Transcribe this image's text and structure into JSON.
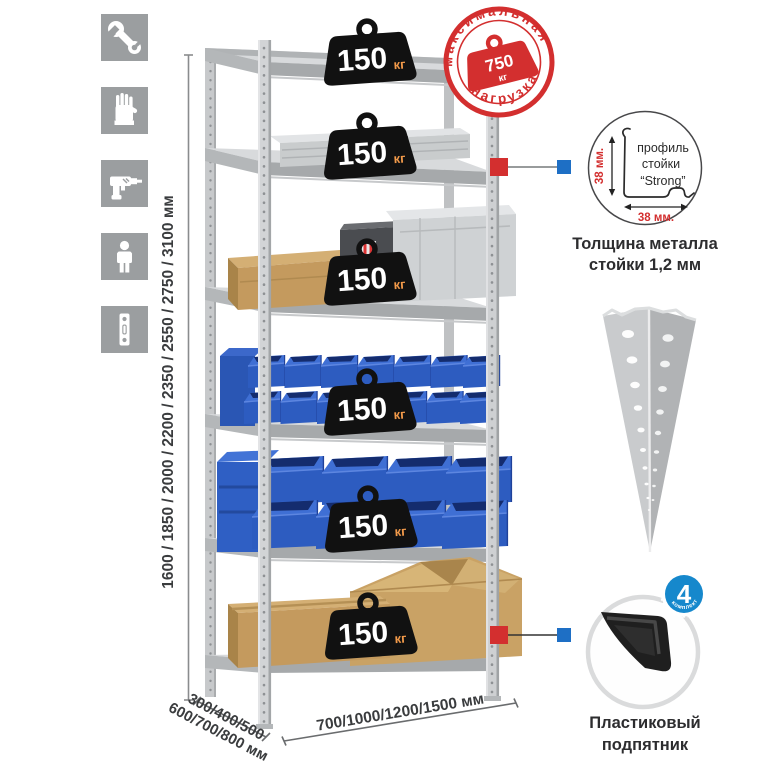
{
  "colors": {
    "accent_red": "#d32f2f",
    "leader_blue": "#1e6fc5",
    "bin_blue": "#2d5cc0",
    "badge_black": "#111111",
    "badge_unit_orange": "#f29a4a",
    "icon_tile_gray": "#9b9ea0",
    "metal_light": "#d7d9db",
    "cardboard": "#c49a5e"
  },
  "left_icons": [
    {
      "name": "wrench-icon"
    },
    {
      "name": "gloves-icon"
    },
    {
      "name": "drill-icon"
    },
    {
      "name": "person-icon"
    },
    {
      "name": "perforated-profile-icon"
    }
  ],
  "dimensions": {
    "height": "1600 / 1850 / 2000 / 2200 / 2350 / 2550 / 2750 / 3100 мм",
    "depth_line1": "300/400/500",
    "depth_line2": "600/700/800 мм",
    "width": "700/1000/1200/1500 мм"
  },
  "rack": {
    "shelves": 6,
    "badges": [
      {
        "value": "150",
        "unit": "кг"
      },
      {
        "value": "150",
        "unit": "кг"
      },
      {
        "value": "150",
        "unit": "кг"
      },
      {
        "value": "150",
        "unit": "кг"
      },
      {
        "value": "150",
        "unit": "кг"
      },
      {
        "value": "150",
        "unit": "кг"
      }
    ]
  },
  "max_load_stamp": {
    "arc_top": "максимальная",
    "arc_bottom": "нагрузка",
    "value": "750",
    "unit": "кг"
  },
  "profile_detail": {
    "label_line1": "профиль",
    "label_line2": "стойки",
    "label_line3": "“Strong”",
    "dim_vertical": "38 мм.",
    "dim_horizontal": "38 мм.",
    "caption_line1": "Толщина металла",
    "caption_line2": "стойки 1,2 мм"
  },
  "included_badge": {
    "count": "4",
    "label": "в комплекте"
  },
  "foot_detail": {
    "caption_line1": "Пластиковый",
    "caption_line2": "подпятник"
  }
}
